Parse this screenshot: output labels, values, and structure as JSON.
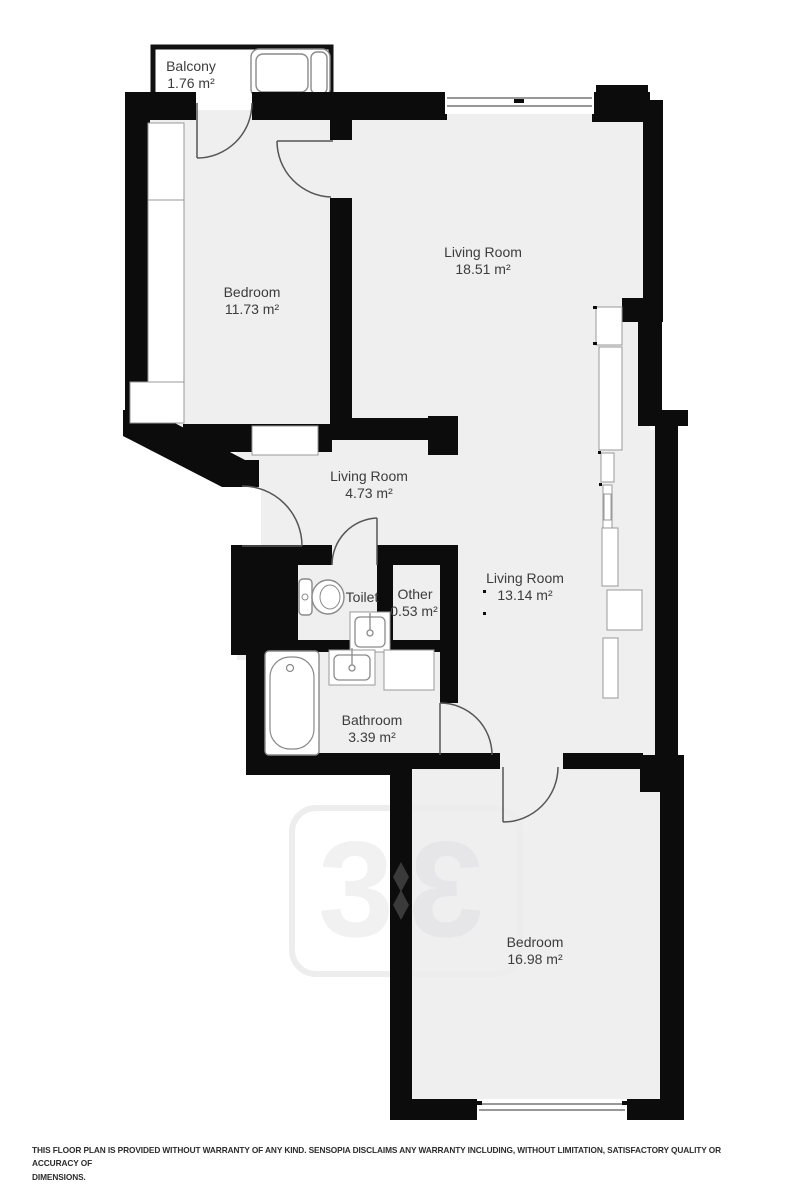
{
  "title": "Apartment floor plan",
  "rooms": [
    {
      "name": "Balcony",
      "area": "1.76 m²"
    },
    {
      "name": "Bedroom",
      "area": "11.73 m²"
    },
    {
      "name": "Living Room",
      "area": "18.51 m²"
    },
    {
      "name": "Living Room",
      "area": "4.73 m²"
    },
    {
      "name": "Toilet",
      "area": ""
    },
    {
      "name": "Other",
      "area": "0.53 m²"
    },
    {
      "name": "Living Room",
      "area": "13.14 m²"
    },
    {
      "name": "Bathroom",
      "area": "3.39 m²"
    },
    {
      "name": "Bedroom",
      "area": "16.98 m²"
    }
  ],
  "watermark": {
    "glyph": "3"
  },
  "disclaimer": {
    "line1": "THIS FLOOR PLAN IS PROVIDED WITHOUT WARRANTY OF ANY KIND. SENSOPIA DISCLAIMS ANY WARRANTY INCLUDING, WITHOUT LIMITATION, SATISFACTORY QUALITY OR ACCURACY OF",
    "line2": "DIMENSIONS."
  },
  "colors": {
    "wall": "#0c0c0c",
    "floor": "#efeff0",
    "fixture_stroke": "#8a8a8a",
    "door_stroke": "#555555",
    "label_text": "#3c3c3c",
    "watermark_light": "#f1f1f1",
    "watermark_on_floor": "#e8e8ea"
  }
}
